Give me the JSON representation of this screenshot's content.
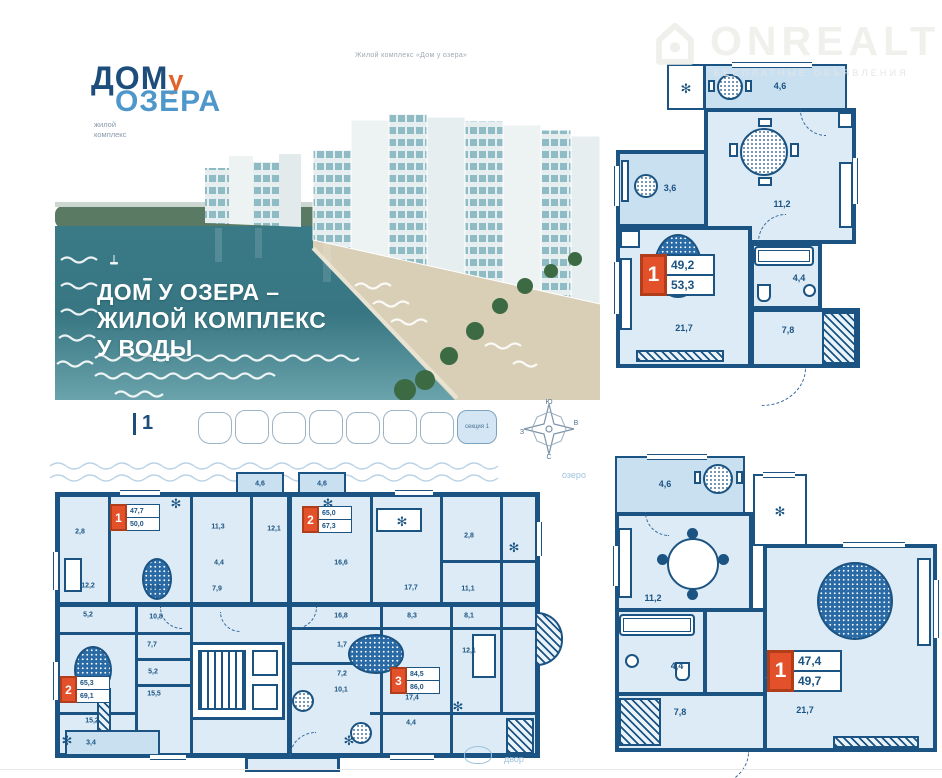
{
  "watermark": {
    "brand": "ONREALT",
    "subtitle": "БЕСПЛАТНЫЕ ОБЪЯВЛЕНИЯ"
  },
  "hero": {
    "caption": "Жилой комплекс «Дом у озера»",
    "logo": {
      "word1": "ДОМ",
      "word2": "у",
      "word3": "ОЗЕРА",
      "sub_line1": "жилой",
      "sub_line2": "комплекс"
    },
    "tagline": [
      "ДОМ У ОЗЕРА –",
      "ЖИЛОЙ КОМПЛЕКС",
      "У ВОДЫ"
    ]
  },
  "site": {
    "floor_label": "1",
    "section_label": "секция 1",
    "lake_label": "озеро",
    "yard_label": "двор",
    "compass": {
      "n": "С",
      "s": "Ю",
      "e": "В",
      "w": "З"
    }
  },
  "plan_a": {
    "tag": {
      "num": "1",
      "upper": "49,2",
      "lower": "53,3"
    },
    "rooms": {
      "balcony": "4,6",
      "loggia": "3,6",
      "kitchen": "11,2",
      "living": "21,7",
      "bath": "4,4",
      "hall": "7,8"
    }
  },
  "plan_b": {
    "tag": {
      "num": "1",
      "upper": "47,4",
      "lower": "49,7"
    },
    "rooms": {
      "balcony": "4,6",
      "kitchen": "11,2",
      "living": "21,7",
      "bath": "4,4",
      "hall": "7,8"
    }
  },
  "floor_plan": {
    "tags": [
      {
        "num": "1",
        "upper": "47,7",
        "lower": "50,0"
      },
      {
        "num": "2",
        "upper": "65,0",
        "lower": "67,3"
      },
      {
        "num": "2",
        "upper": "65,3",
        "lower": "69,1"
      },
      {
        "num": "3",
        "upper": "84,5",
        "lower": "86,0"
      }
    ],
    "rooms": [
      "4,6",
      "4,6",
      "2,8",
      "11,3",
      "4,4",
      "7,9",
      "12,1",
      "12,2",
      "21,8",
      "16,6",
      "17,7",
      "11,1",
      "2,8",
      "5,2",
      "10,8",
      "7,7",
      "5,2",
      "15,5",
      "15,2",
      "3,4",
      "16,8",
      "8,3",
      "8,1",
      "1,7",
      "7,2",
      "10,1",
      "17,4",
      "12,1",
      "4,4"
    ]
  }
}
